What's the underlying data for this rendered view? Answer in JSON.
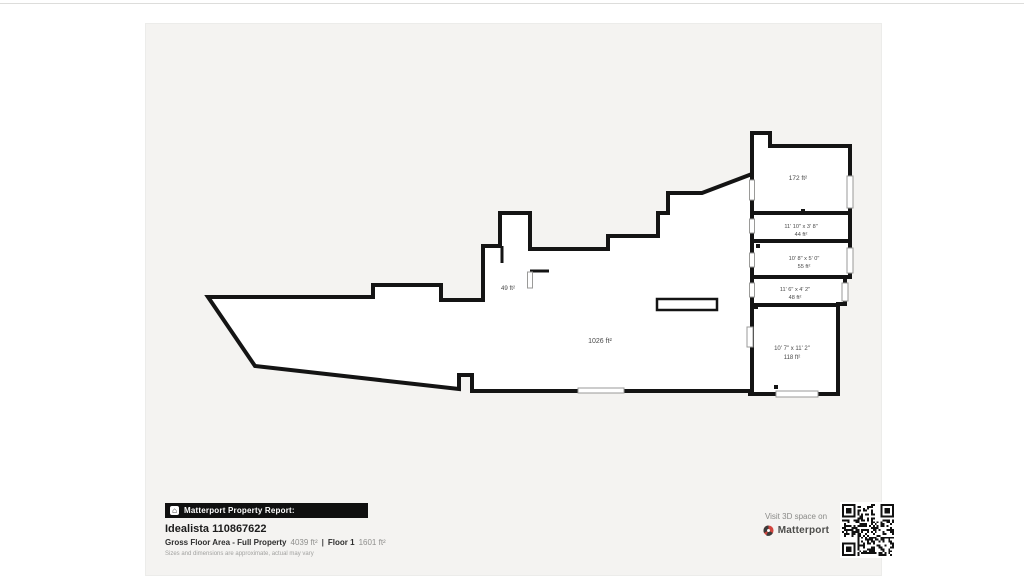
{
  "floorplan": {
    "rooms": {
      "main": {
        "area": "1026 ft²"
      },
      "small": {
        "area": "49 ft²"
      },
      "top": {
        "area": "172 ft²"
      },
      "r44": {
        "dims": "11' 10\" x 3' 8\"",
        "area": "44 ft²"
      },
      "r55": {
        "dims": "10' 8\" x 5' 0\"",
        "area": "55 ft²"
      },
      "r48": {
        "dims": "11' 6\" x 4' 2\"",
        "area": "48 ft²"
      },
      "r118": {
        "dims": "10' 7\" x 11' 2\"",
        "area": "118 ft²"
      }
    }
  },
  "footer": {
    "badge_icon": "⌂",
    "badge_label": "Matterport Property Report:",
    "property_name": "Idealista 110867622",
    "gross_label": "Gross Floor Area - Full Property",
    "gross_value": "4039 ft²",
    "separator": "|",
    "floor_label": "Floor 1",
    "floor_value": "1601 ft²",
    "disclaimer": "Sizes and dimensions are approximate, actual may vary"
  },
  "cta": {
    "visit_text": "Visit 3D space on",
    "brand": "Matterport"
  },
  "colors": {
    "wall": "#141414",
    "page_bg": "#f4f3f1",
    "brand_red": "#d0453e"
  }
}
